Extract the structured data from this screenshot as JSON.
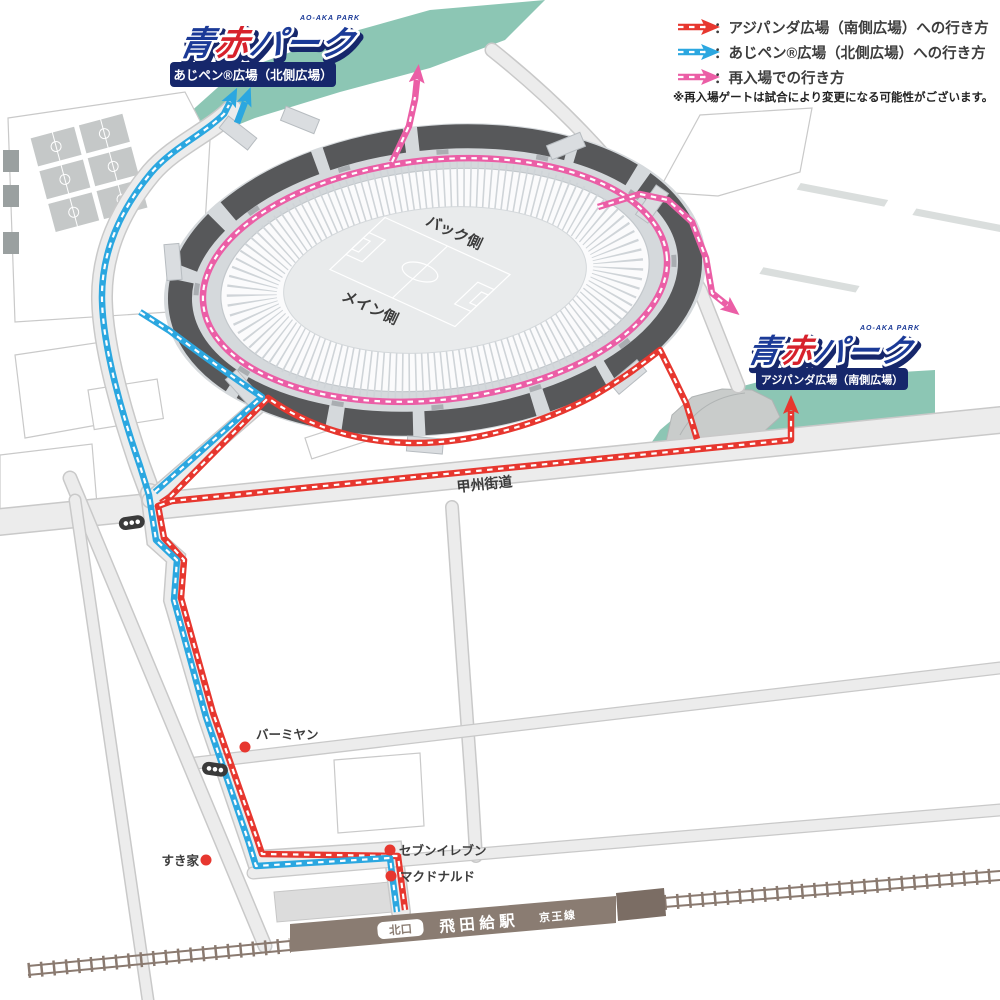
{
  "legend": {
    "rows": [
      {
        "key": "south",
        "color": "#e7372f",
        "label": "：アジパンダ広場（南側広場）への行き方"
      },
      {
        "key": "north",
        "color": "#2ba7e0",
        "label": "：あじペン®広場（北側広場）への行き方"
      },
      {
        "key": "reentry",
        "color": "#eb5ea6",
        "label": "：再入場での行き方"
      }
    ],
    "note": "※再入場ゲートは試合により変更になる可能性がございます。"
  },
  "logo_north": {
    "small": "AO-AKA PARK",
    "full": "青赤パーク",
    "char1": "青",
    "char2": "赤",
    "char3": "パーク",
    "plaza": "あじペン®広場（北側広場）"
  },
  "logo_south": {
    "small": "AO-AKA PARK",
    "full": "青赤パーク",
    "char1": "青",
    "char2": "赤",
    "char3": "パーク",
    "plaza": "アジパンダ広場（南側広場）"
  },
  "stadium": {
    "back": "バック側",
    "main": "メイン側"
  },
  "road_label": "甲州街道",
  "landmarks": {
    "bamiyan": "バーミヤン",
    "sukiya": "すき家",
    "seven": "セブンイレブン",
    "mcdonalds": "マクドナルド"
  },
  "station": {
    "exit": "北口",
    "name": "飛田給駅",
    "line": "京王線"
  },
  "colors": {
    "route_red": "#e7372f",
    "route_blue": "#2ba7e0",
    "route_pink": "#eb5ea6",
    "plaza_teal": "#8cc6b4",
    "pitch_teal": "#7dc3ae",
    "aux_field": "#c7cbca",
    "ring_dark": "#57585a",
    "walkway": "#d5d9dc",
    "station_brown": "#8a7c72",
    "rail_brown": "#8a7a70",
    "navy": "#16276b",
    "logo_blue": "#1b3a97",
    "logo_red": "#d7222c"
  }
}
